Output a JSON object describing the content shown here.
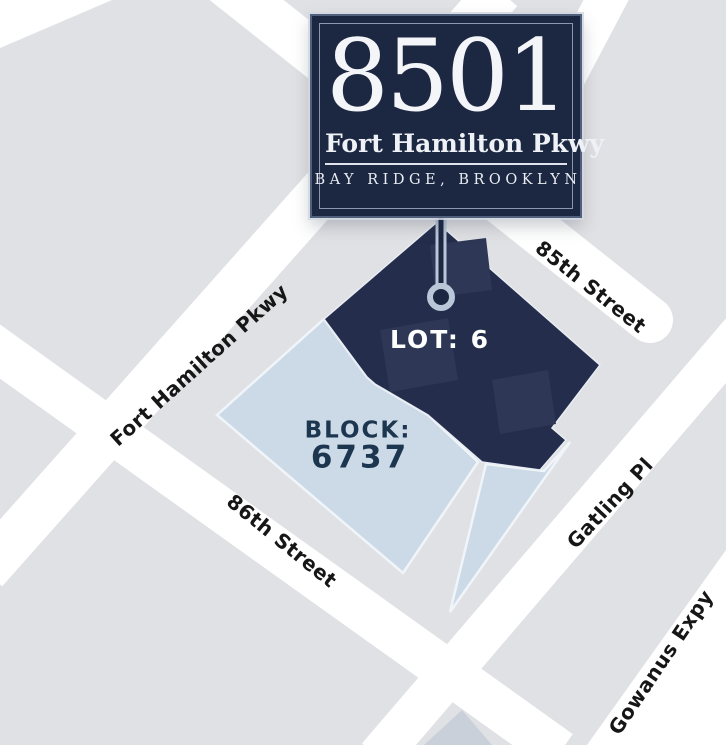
{
  "callout": {
    "number": "8501",
    "street": "Fort Hamilton Pkwy",
    "city": "BAY RIDGE, BROOKLYN"
  },
  "map": {
    "lot_label": "LOT: 6",
    "block_label": "BLOCK:",
    "block_number": "6737",
    "street_labels": {
      "s85": "85th Street",
      "fhp": "Fort Hamilton Pkwy",
      "s86": "86th Street",
      "gatling": "Gatling Pl",
      "gowanus": "Gowanus Expy"
    }
  },
  "colors": {
    "background": "#e0e1e4",
    "street": "#ffffff",
    "lot_navy": "#242e4c",
    "building_navy": "#2e3856",
    "block_blue": "#ccd9e6",
    "block_outline": "#f0f5fa",
    "sign_navy": "#1c2742",
    "marker_ring": "#b9c7d8",
    "map_text_navy": "#1d3650",
    "street_text": "#161616",
    "shadow_block": "#c9d0da"
  }
}
